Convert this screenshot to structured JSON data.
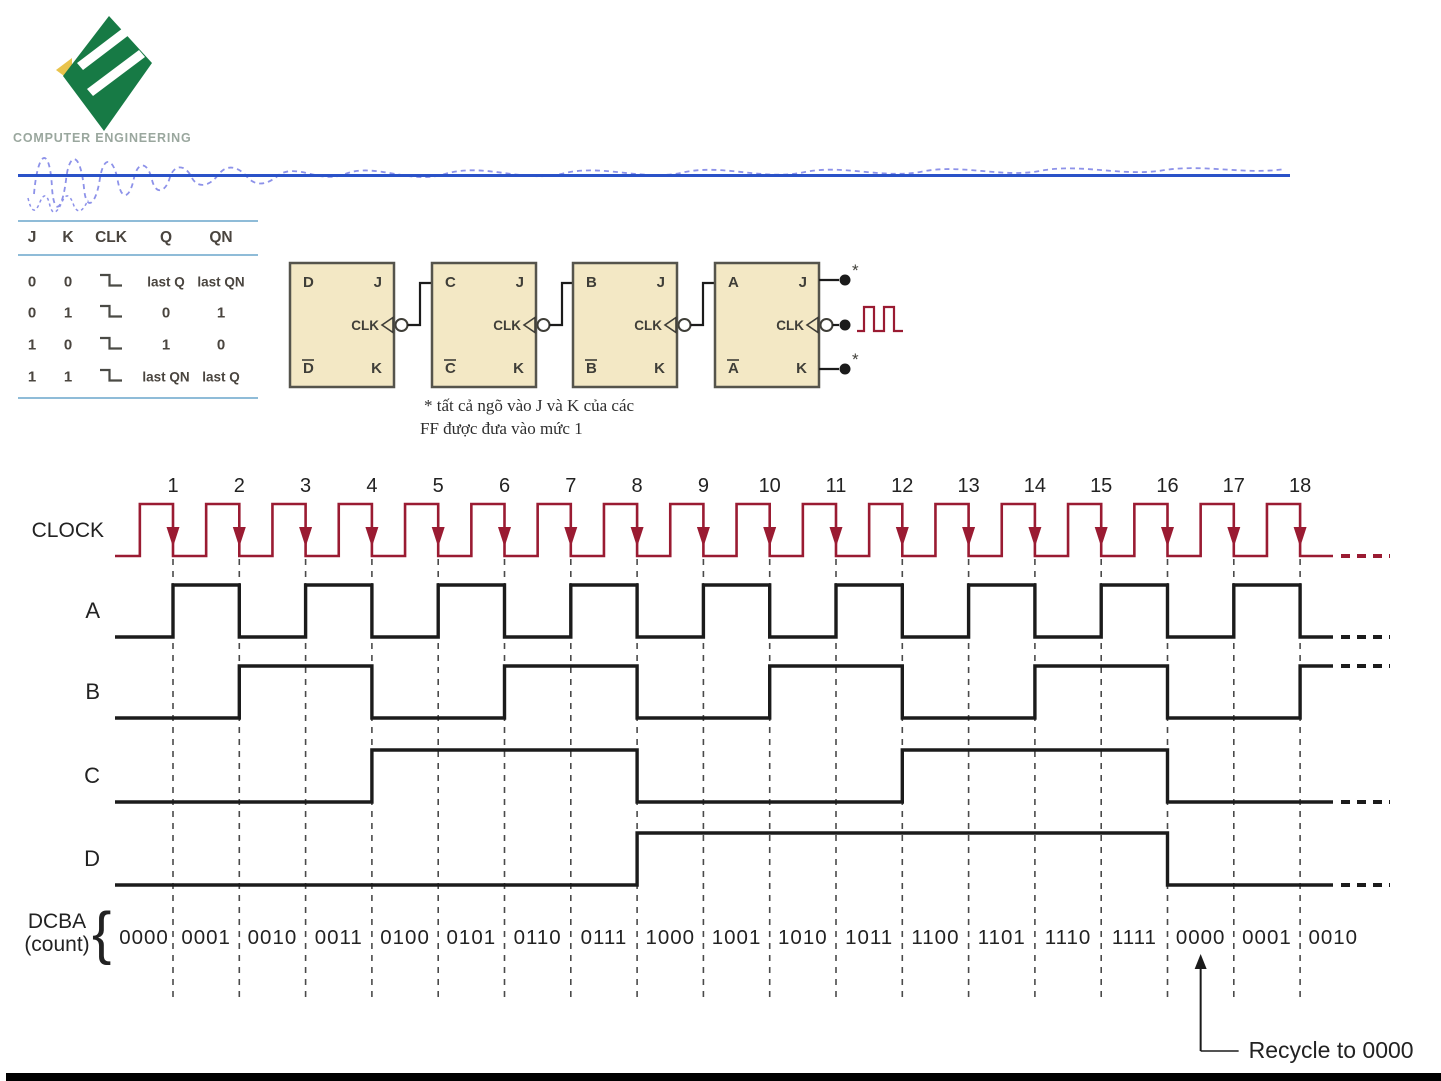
{
  "header": {
    "logo_caption": "COMPUTER ENGINEERING",
    "colors": {
      "rule": "#2a52c8",
      "scribble": "#8d92e9",
      "logo_green": "#177a45",
      "logo_yellow": "#e9c34b",
      "caption": "#9aa79e"
    }
  },
  "truth_table": {
    "headers": [
      "J",
      "K",
      "CLK",
      "Q",
      "QN"
    ],
    "rows": [
      {
        "j": "0",
        "k": "0",
        "clk": "falling-edge",
        "q": "last Q",
        "qn": "last QN"
      },
      {
        "j": "0",
        "k": "1",
        "clk": "falling-edge",
        "q": "0",
        "qn": "1"
      },
      {
        "j": "1",
        "k": "0",
        "clk": "falling-edge",
        "q": "1",
        "qn": "0"
      },
      {
        "j": "1",
        "k": "1",
        "clk": "falling-edge",
        "q": "last QN",
        "qn": "last Q"
      }
    ],
    "line_color": "#8fbcd8"
  },
  "circuit": {
    "flipflops": [
      {
        "output": "D",
        "output_bar": "D",
        "j": "J",
        "k": "K",
        "clk": "CLK"
      },
      {
        "output": "C",
        "output_bar": "C",
        "j": "J",
        "k": "K",
        "clk": "CLK"
      },
      {
        "output": "B",
        "output_bar": "B",
        "j": "J",
        "k": "K",
        "clk": "CLK"
      },
      {
        "output": "A",
        "output_bar": "A",
        "j": "J",
        "k": "K",
        "clk": "CLK"
      }
    ],
    "jk_tie_marker": "*",
    "note_line1": "* tất cả ngõ vào J và K của các",
    "note_line2": "FF được đưa vào mức 1",
    "colors": {
      "box_fill": "#f3e8c5",
      "box_border": "#55544c",
      "wire": "#1b1b1b",
      "clock_glyph": "#9a1b32",
      "label": "#3f3e38"
    }
  },
  "chart_data": {
    "type": "digital-timing",
    "clock": {
      "label": "CLOCK",
      "pulses": 18,
      "pulse_numbers": [
        1,
        2,
        3,
        4,
        5,
        6,
        7,
        8,
        9,
        10,
        11,
        12,
        13,
        14,
        15,
        16,
        17,
        18
      ]
    },
    "signals": [
      {
        "name": "A",
        "initial": 0,
        "toggle_edges": [
          1,
          2,
          3,
          4,
          5,
          6,
          7,
          8,
          9,
          10,
          11,
          12,
          13,
          14,
          15,
          16,
          17,
          18
        ]
      },
      {
        "name": "B",
        "initial": 0,
        "toggle_edges": [
          2,
          4,
          6,
          8,
          10,
          12,
          14,
          16,
          18
        ]
      },
      {
        "name": "C",
        "initial": 0,
        "toggle_edges": [
          4,
          8,
          12,
          16
        ]
      },
      {
        "name": "D",
        "initial": 0,
        "toggle_edges": [
          8,
          16
        ]
      }
    ],
    "counts": [
      "0000",
      "0001",
      "0010",
      "0011",
      "0100",
      "0101",
      "0110",
      "0111",
      "1000",
      "1001",
      "1010",
      "1011",
      "1100",
      "1101",
      "1110",
      "1111",
      "0000",
      "0001",
      "0010"
    ],
    "count_label_top": "DCBA",
    "count_label_bottom": "(count)",
    "count_brace": "{",
    "recycle_label": "Recycle to 0000",
    "colors": {
      "clock": "#9a1b32",
      "signal": "#1b1b1b",
      "dashed": "#4a4a4a",
      "text": "#222222"
    }
  }
}
